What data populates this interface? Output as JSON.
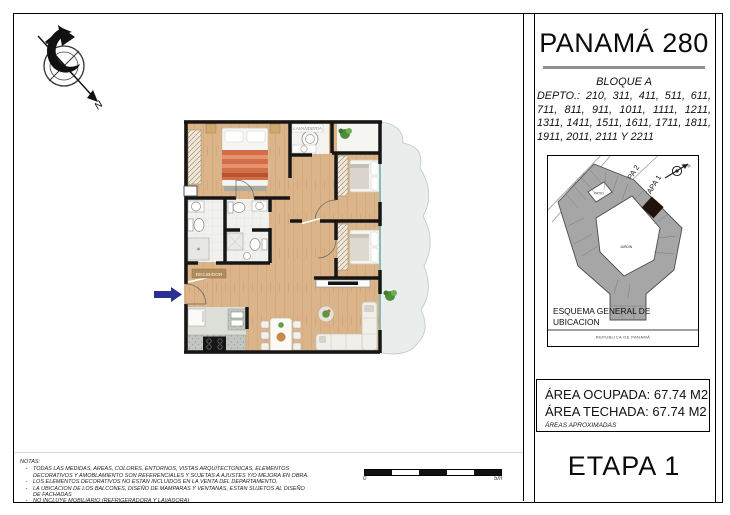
{
  "sheet": {
    "title": "PANAMÁ 280",
    "block": "BLOQUE A",
    "depto_list": "DEPTO.: 210, 311, 411, 511, 611, 711, 811, 911, 1011, 1111, 1211, 1311, 1411, 1511, 1611, 1711, 1811, 1911, 2011, 2111 Y 2211",
    "stage": "ETAPA 1"
  },
  "location_map": {
    "etapa_2": "ETAPA 2",
    "etapa_1": "ETAPA 1",
    "street": "PEDRO MIGUEL",
    "patio": "PATIO",
    "jardin": "JARDIN",
    "north": "N",
    "caption_line1": "ESQUEMA GENERAL DE",
    "caption_line2": "UBICACION",
    "country": "REPUBLICA DE PANAMÁ"
  },
  "areas": {
    "occupied_label": "ÁREA OCUPADA:",
    "occupied_value": "67.74 M2",
    "roofed_label": "ÁREA TECHADA:",
    "roofed_value": "67.74 M2",
    "disclaimer": "ÁREAS APROXIMADAS"
  },
  "floor_plan": {
    "entry_label": "RECIBIDOR",
    "laundry_label": "LAVANDERIA"
  },
  "compass": {
    "north": "N"
  },
  "scale_bar": {
    "start": "0",
    "end": "5m"
  },
  "notes": {
    "title": "NOTAS:",
    "bullet": "-",
    "items": [
      "TODAS LAS MEDIDAS, AREAS, COLORES, ENTORNOS, VISTAS ARQUITECTONICAS, ELEMENTOS DECORATIVOS Y AMOBLAMIENTO SON REFERENCIALES Y SUJETAS A AJUSTES Y/O MEJORA EN OBRA.",
      "LOS ELEMENTOS DECORATIVOS NO ESTAN INCLUIDOS EN LA VENTA DEL DEPARTAMENTO.",
      "LA UBICACION DE LOS BALCONES, DISEÑO DE MAMPARAS Y VENTANAS, ESTAN SUJETOS AL DISEÑO DE FACHADAS",
      "NO INCLUYE MOBILIARIO (REFRIGERADORA Y LAVADORA)"
    ]
  },
  "colors": {
    "wall": "#161616",
    "wood_floor": "#dcb489",
    "entry_arrow": "#2b2f92",
    "balcony": "#e9edec",
    "map_building": "#a6a6a6",
    "map_highlight": "#20130c"
  }
}
